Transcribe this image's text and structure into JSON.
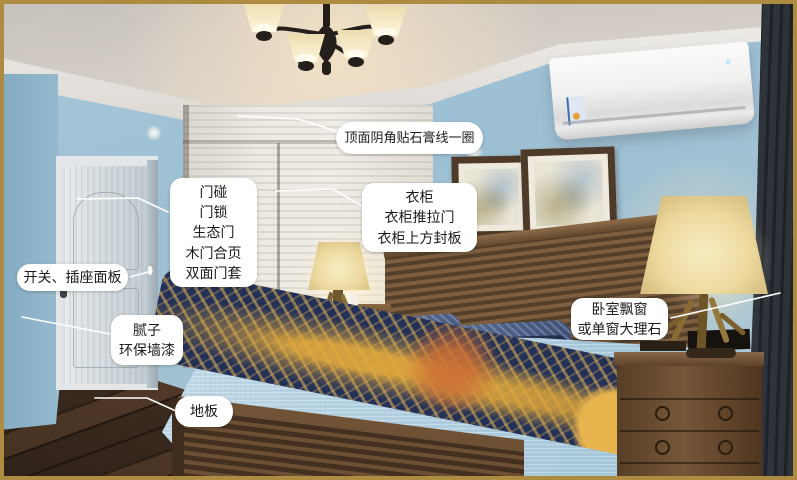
{
  "meta": {
    "description": "Annotated photo of an American-style bedroom pointing out decoration work items",
    "language": "zh-CN"
  },
  "annotations": [
    {
      "name": "ceiling-molding",
      "lines": [
        "顶面阴角贴石膏线一圈"
      ]
    },
    {
      "name": "door-hardware",
      "lines": [
        "门碰",
        "门锁",
        "生态门",
        "木门合页",
        "双面门套"
      ]
    },
    {
      "name": "switch-socket",
      "lines": [
        "开关、插座面板"
      ]
    },
    {
      "name": "wall-finish",
      "lines": [
        "腻子",
        "环保墙漆"
      ]
    },
    {
      "name": "floor",
      "lines": [
        "地板"
      ]
    },
    {
      "name": "wardrobe",
      "lines": [
        "衣柜",
        "衣柜推拉门",
        "衣柜上方封板"
      ]
    },
    {
      "name": "bay-window",
      "lines": [
        "卧室飘窗",
        "或单窗大理石"
      ]
    }
  ],
  "palette": {
    "frame_gold": "#ad8c41",
    "wall_blue": "#a3c2d5",
    "ceiling_gray": "#d3ccc5",
    "molding_white": "#f0eeea",
    "wood_floor_dark": "#4a3522",
    "furniture_wood": "#6d4f35",
    "bedding_blue": "#b9d4e2",
    "throw_navy": "#233158",
    "throw_gold": "#dfa63c",
    "lamp_glow": "#f2e2ab",
    "curtain_slate": "#454b54",
    "label_bg": "#ffffff",
    "label_text": "#1a1a1a",
    "pointer_line": "#ffffff"
  }
}
